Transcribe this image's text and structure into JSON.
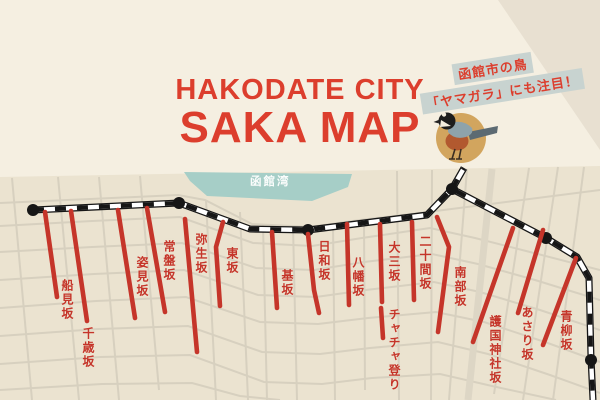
{
  "title": {
    "line1": "HAKODATE CITY",
    "line2": "SAKA MAP"
  },
  "callout": {
    "line1": "函館市の鳥",
    "line2": "「ヤマガラ」にも注目！",
    "bird_icon": "yamagara-bird"
  },
  "bay": {
    "label": "函館湾"
  },
  "colors": {
    "page_bg": "#f5efe1",
    "map_bg": "#ebe3d0",
    "street": "#d7d0bf",
    "street_wide": "#ddd6c5",
    "bay": "#a6cec7",
    "accent_red": "#dc3e2d",
    "slope_red": "#c5352a",
    "tram_black": "#161616",
    "tram_white": "#ffffff",
    "strip_bg": "#c8d3d0",
    "bird_circle": "#d2a55e"
  },
  "map": {
    "outline": [
      [
        0,
        177
      ],
      [
        600,
        166
      ],
      [
        600,
        400
      ],
      [
        0,
        400
      ]
    ],
    "bay_polygon": [
      [
        184,
        172
      ],
      [
        352,
        174
      ],
      [
        348,
        187
      ],
      [
        312,
        201
      ],
      [
        207,
        196
      ],
      [
        190,
        181
      ]
    ],
    "h_streets": [
      [
        [
          0,
          203
        ],
        [
          90,
          199
        ],
        [
          178,
          195
        ],
        [
          205,
          200
        ],
        [
          252,
          224
        ],
        [
          310,
          227
        ],
        [
          360,
          220
        ],
        [
          428,
          212
        ],
        [
          600,
          190
        ]
      ],
      [
        [
          0,
          226
        ],
        [
          92,
          221
        ],
        [
          180,
          217
        ],
        [
          253,
          243
        ],
        [
          312,
          246
        ],
        [
          362,
          238
        ],
        [
          430,
          228
        ],
        [
          475,
          238
        ],
        [
          530,
          252
        ],
        [
          600,
          270
        ]
      ],
      [
        [
          0,
          252
        ],
        [
          92,
          247
        ],
        [
          182,
          243
        ],
        [
          256,
          268
        ],
        [
          314,
          270
        ],
        [
          364,
          262
        ],
        [
          432,
          254
        ],
        [
          478,
          264
        ],
        [
          535,
          280
        ],
        [
          600,
          300
        ]
      ],
      [
        [
          0,
          280
        ],
        [
          94,
          274
        ],
        [
          184,
          270
        ],
        [
          258,
          295
        ],
        [
          316,
          297
        ],
        [
          366,
          290
        ],
        [
          434,
          282
        ],
        [
          480,
          292
        ],
        [
          540,
          310
        ],
        [
          600,
          330
        ]
      ],
      [
        [
          0,
          308
        ],
        [
          96,
          301
        ],
        [
          186,
          297
        ],
        [
          260,
          322
        ],
        [
          318,
          324
        ],
        [
          368,
          318
        ],
        [
          436,
          312
        ],
        [
          484,
          322
        ],
        [
          545,
          342
        ],
        [
          600,
          362
        ]
      ],
      [
        [
          0,
          336
        ],
        [
          98,
          329
        ],
        [
          188,
          326
        ],
        [
          262,
          352
        ],
        [
          320,
          354
        ],
        [
          370,
          348
        ],
        [
          438,
          342
        ],
        [
          488,
          354
        ],
        [
          550,
          375
        ],
        [
          600,
          393
        ]
      ],
      [
        [
          0,
          364
        ],
        [
          100,
          357
        ],
        [
          190,
          355
        ],
        [
          264,
          382
        ],
        [
          322,
          384
        ],
        [
          372,
          378
        ],
        [
          440,
          374
        ],
        [
          492,
          386
        ],
        [
          556,
          400
        ]
      ],
      [
        [
          0,
          390
        ],
        [
          102,
          384
        ],
        [
          192,
          383
        ],
        [
          240,
          396
        ],
        [
          280,
          400
        ]
      ]
    ],
    "v_streets": [
      [
        [
          12,
          178
        ],
        [
          32,
          400
        ]
      ],
      [
        [
          58,
          177
        ],
        [
          79,
          400
        ]
      ],
      [
        [
          99,
          177
        ],
        [
          119,
          400
        ]
      ],
      [
        [
          140,
          176
        ],
        [
          159,
          390
        ]
      ],
      [
        [
          206,
          200
        ],
        [
          216,
          400
        ]
      ],
      [
        [
          240,
          212
        ],
        [
          248,
          400
        ]
      ],
      [
        [
          263,
          224
        ],
        [
          267,
          400
        ]
      ],
      [
        [
          293,
          226
        ],
        [
          297,
          400
        ]
      ],
      [
        [
          333,
          225
        ],
        [
          335,
          400
        ]
      ],
      [
        [
          364,
          222
        ],
        [
          365,
          390
        ]
      ],
      [
        [
          397,
          171
        ],
        [
          399,
          400
        ]
      ],
      [
        [
          432,
          170
        ],
        [
          431,
          400
        ]
      ],
      [
        [
          467,
          169
        ],
        [
          449,
          400
        ]
      ],
      [
        [
          529,
          168
        ],
        [
          494,
          394
        ]
      ],
      [
        [
          558,
          167
        ],
        [
          523,
          400
        ]
      ],
      [
        [
          584,
          167
        ],
        [
          553,
          400
        ]
      ]
    ],
    "wide_streets": [
      [
        [
          492,
          169
        ],
        [
          468,
          400
        ]
      ]
    ],
    "tram": {
      "main": [
        [
          33,
          210
        ],
        [
          179,
          203
        ],
        [
          250,
          229
        ],
        [
          308,
          230
        ],
        [
          427,
          215
        ],
        [
          452,
          189
        ],
        [
          546,
          238
        ],
        [
          577,
          257
        ],
        [
          589,
          278
        ],
        [
          591,
          358
        ],
        [
          593,
          400
        ]
      ],
      "branch": [
        [
          452,
          189
        ],
        [
          464,
          168
        ]
      ],
      "stations": [
        [
          33,
          210
        ],
        [
          179,
          203
        ],
        [
          308,
          230
        ],
        [
          452,
          189
        ],
        [
          546,
          238
        ],
        [
          591,
          360
        ]
      ]
    },
    "slopes": [
      {
        "name": "船見坂",
        "line": [
          [
            45,
            212
          ],
          [
            57,
            297
          ]
        ],
        "label": [
          59,
          279
        ]
      },
      {
        "name": "千歳坂",
        "line": [
          [
            71,
            211
          ],
          [
            87,
            321
          ]
        ],
        "label": [
          80,
          327
        ]
      },
      {
        "name": "姿見坂",
        "line": [
          [
            118,
            210
          ],
          [
            135,
            318
          ]
        ],
        "label": [
          134,
          256
        ]
      },
      {
        "name": "常盤坂",
        "line": [
          [
            147,
            208
          ],
          [
            165,
            312
          ]
        ],
        "label": [
          161,
          240
        ]
      },
      {
        "name": "弥生坂",
        "line": [
          [
            185,
            219
          ],
          [
            197,
            352
          ]
        ],
        "label": [
          193,
          233
        ]
      },
      {
        "name": "東坂",
        "line": [
          [
            223,
            222
          ],
          [
            216,
            247
          ],
          [
            220,
            306
          ]
        ],
        "label": [
          224,
          247
        ]
      },
      {
        "name": "基坂",
        "line": [
          [
            272,
            232
          ],
          [
            277,
            308
          ]
        ],
        "label": [
          279,
          269
        ]
      },
      {
        "name": "日和坂",
        "line": [
          [
            308,
            234
          ],
          [
            314,
            290
          ],
          [
            319,
            313
          ]
        ],
        "label": [
          316,
          240
        ]
      },
      {
        "name": "八幡坂",
        "line": [
          [
            347,
            224
          ],
          [
            349,
            305
          ]
        ],
        "label": [
          350,
          256
        ]
      },
      {
        "name": "大三坂",
        "line": [
          [
            380,
            224
          ],
          [
            382,
            302
          ]
        ],
        "label": [
          386,
          241
        ]
      },
      {
        "name": "チャチャ登り",
        "line": [
          [
            381,
            308
          ],
          [
            383,
            338
          ]
        ],
        "label": [
          386,
          308
        ]
      },
      {
        "name": "二十間坂",
        "line": [
          [
            412,
            222
          ],
          [
            414,
            300
          ]
        ],
        "label": [
          417,
          235
        ]
      },
      {
        "name": "南部坂",
        "line": [
          [
            437,
            217
          ],
          [
            449,
            247
          ],
          [
            438,
            332
          ]
        ],
        "label": [
          452,
          266
        ]
      },
      {
        "name": "護国神社坂",
        "line": [
          [
            513,
            228
          ],
          [
            473,
            342
          ]
        ],
        "label": [
          487,
          315
        ]
      },
      {
        "name": "あさり坂",
        "line": [
          [
            543,
            230
          ],
          [
            518,
            313
          ]
        ],
        "label": [
          519,
          306
        ]
      },
      {
        "name": "青柳坂",
        "line": [
          [
            576,
            258
          ],
          [
            543,
            345
          ]
        ],
        "label": [
          558,
          310
        ]
      }
    ]
  }
}
